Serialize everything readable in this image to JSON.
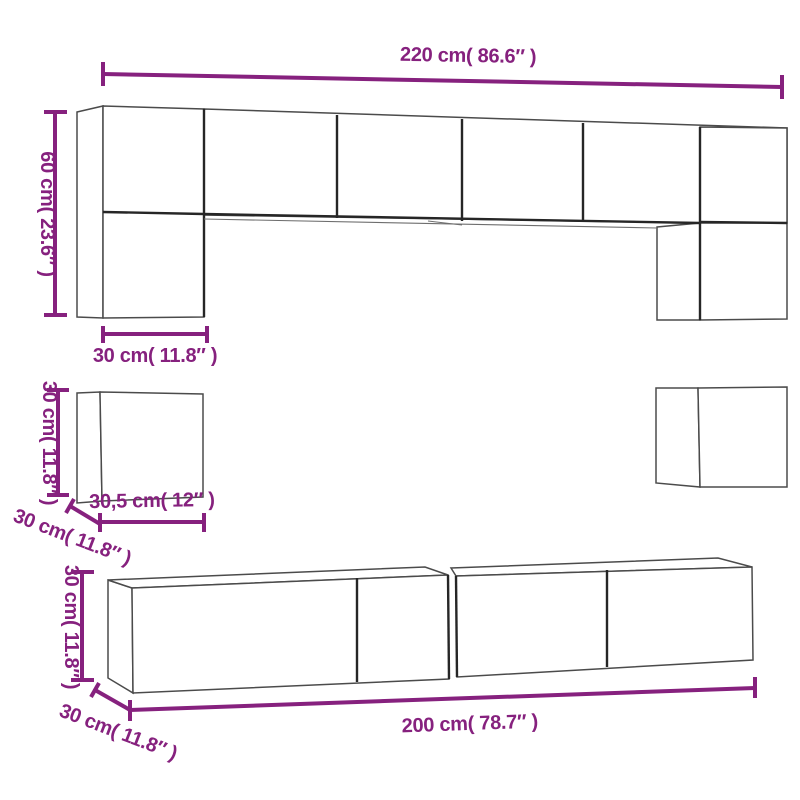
{
  "diagram": {
    "type": "furniture-dimension-diagram",
    "subject": "8-piece TV wall cabinet set with dimension callouts",
    "background_color": "#ffffff",
    "outline_color": "#4b4b4b",
    "outline_dark_color": "#262626",
    "dimension_color": "#86217e"
  },
  "dimensions": {
    "top_total_width": "220 cm( 86.6″ )",
    "tall_cabinet_height": "60 cm( 23.6″ )",
    "tall_cabinet_width": "30 cm( 11.8″ )",
    "cube_height": "30 cm( 11.8″ )",
    "cube_width": "30,5 cm( 12″ )",
    "cube_depth": "30 cm( 11.8″ )",
    "stand_height": "30 cm( 11.8″ )",
    "stand_width": "200 cm( 78.7″ )",
    "stand_depth": "30 cm( 11.8″ )"
  }
}
